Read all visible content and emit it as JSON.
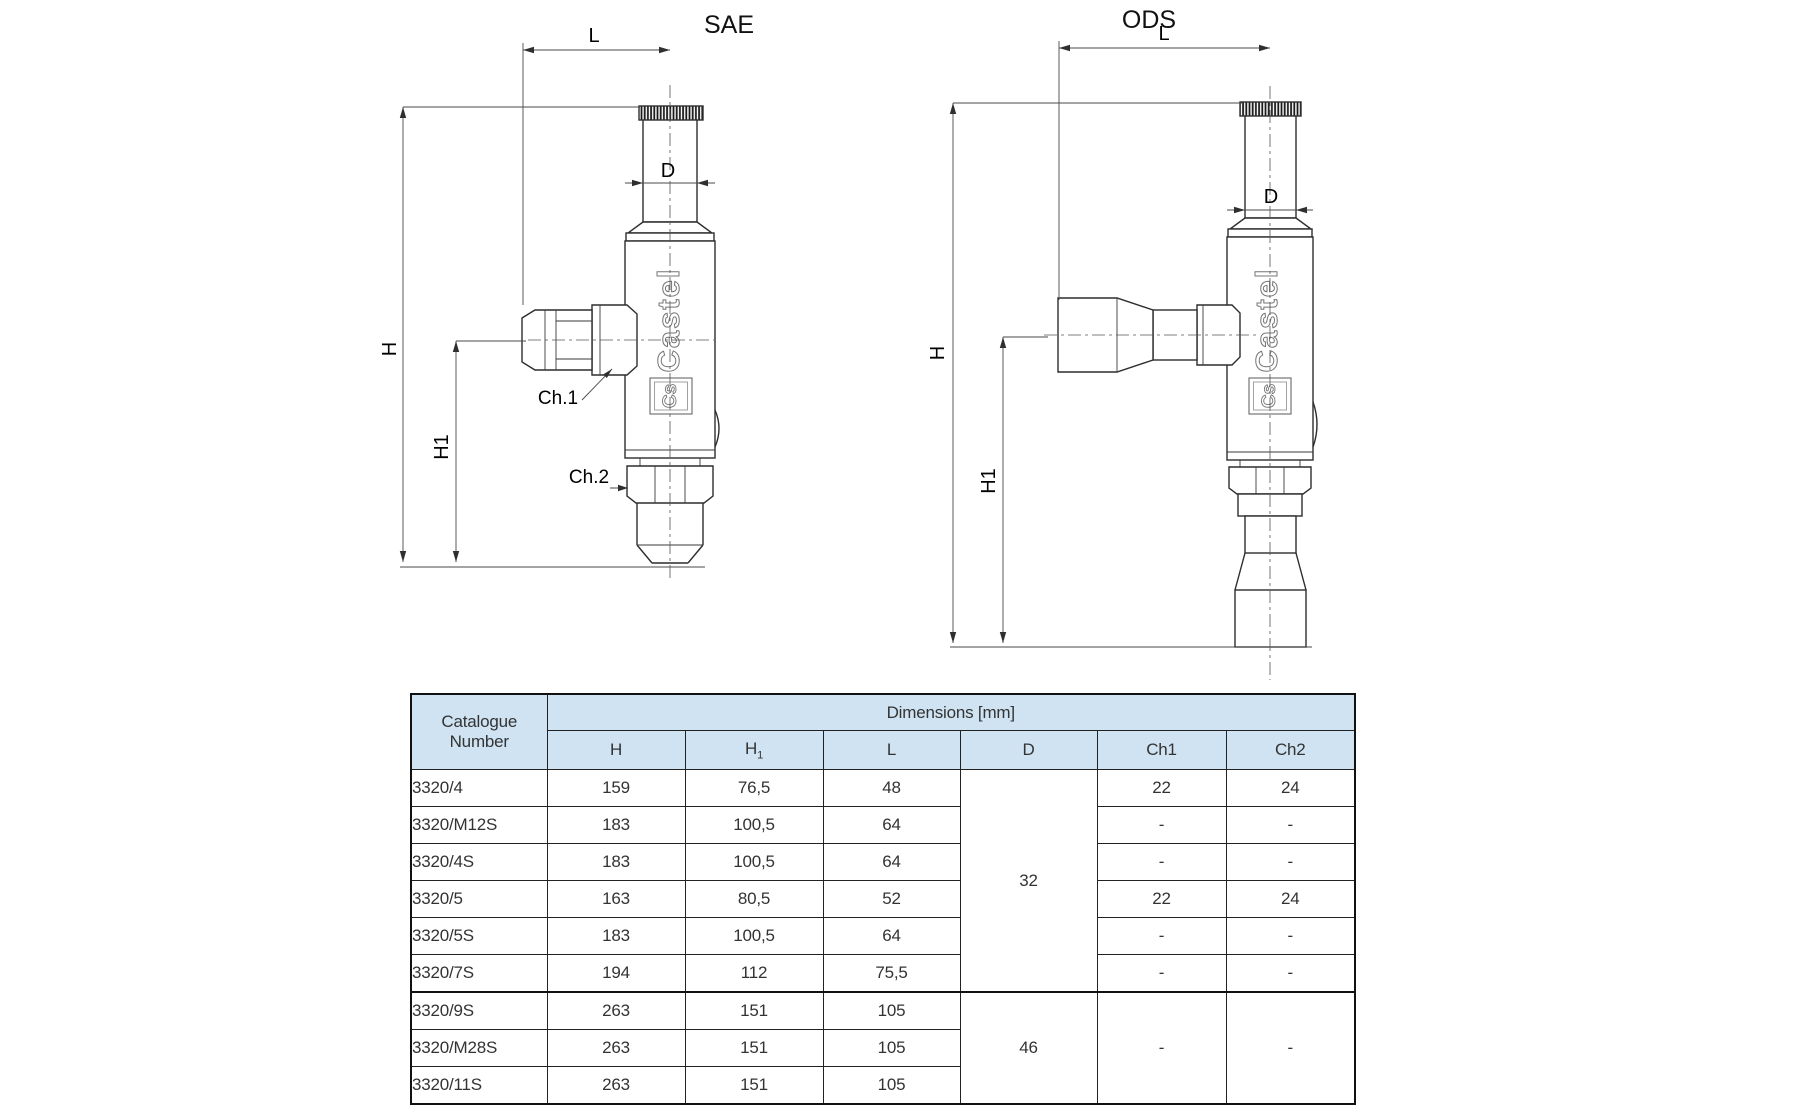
{
  "page": {
    "background": "#ffffff"
  },
  "drawings": {
    "sae": {
      "title": "SAE",
      "dim_l": "L",
      "dim_d": "D",
      "dim_h": "H",
      "dim_h1": "H1",
      "ch1": "Ch.1",
      "ch2": "Ch.2",
      "brand": "Castel",
      "monogram": "Cs"
    },
    "ods": {
      "title": "ODS",
      "dim_l": "L",
      "dim_d": "D",
      "dim_h": "H",
      "dim_h1": "H1",
      "brand": "Castel",
      "monogram": "Cs"
    }
  },
  "table": {
    "accent_bg": "#cfe3f3",
    "header": {
      "catalogue_line1": "Catalogue",
      "catalogue_line2": "Number",
      "dimensions": "Dimensions [mm]",
      "col_h": "H",
      "col_h1_base": "H",
      "col_h1_sub": "1",
      "col_l": "L",
      "col_d": "D",
      "col_ch1": "Ch1",
      "col_ch2": "Ch2"
    },
    "d_groups": [
      {
        "value": "32"
      },
      {
        "value": "46"
      }
    ],
    "ch_groups": {
      "ch1": "-",
      "ch2": "-"
    },
    "rows": [
      {
        "catalogue": "3320/4",
        "h": "159",
        "h1": "76,5",
        "l": "48",
        "ch1": "22",
        "ch2": "24"
      },
      {
        "catalogue": "3320/M12S",
        "h": "183",
        "h1": "100,5",
        "l": "64",
        "ch1": "-",
        "ch2": "-"
      },
      {
        "catalogue": "3320/4S",
        "h": "183",
        "h1": "100,5",
        "l": "64",
        "ch1": "-",
        "ch2": "-"
      },
      {
        "catalogue": "3320/5",
        "h": "163",
        "h1": "80,5",
        "l": "52",
        "ch1": "22",
        "ch2": "24"
      },
      {
        "catalogue": "3320/5S",
        "h": "183",
        "h1": "100,5",
        "l": "64",
        "ch1": "-",
        "ch2": "-"
      },
      {
        "catalogue": "3320/7S",
        "h": "194",
        "h1": "112",
        "l": "75,5",
        "ch1": "-",
        "ch2": "-"
      },
      {
        "catalogue": "3320/9S",
        "h": "263",
        "h1": "151",
        "l": "105"
      },
      {
        "catalogue": "3320/M28S",
        "h": "263",
        "h1": "151",
        "l": "105"
      },
      {
        "catalogue": "3320/11S",
        "h": "263",
        "h1": "151",
        "l": "105"
      }
    ]
  }
}
